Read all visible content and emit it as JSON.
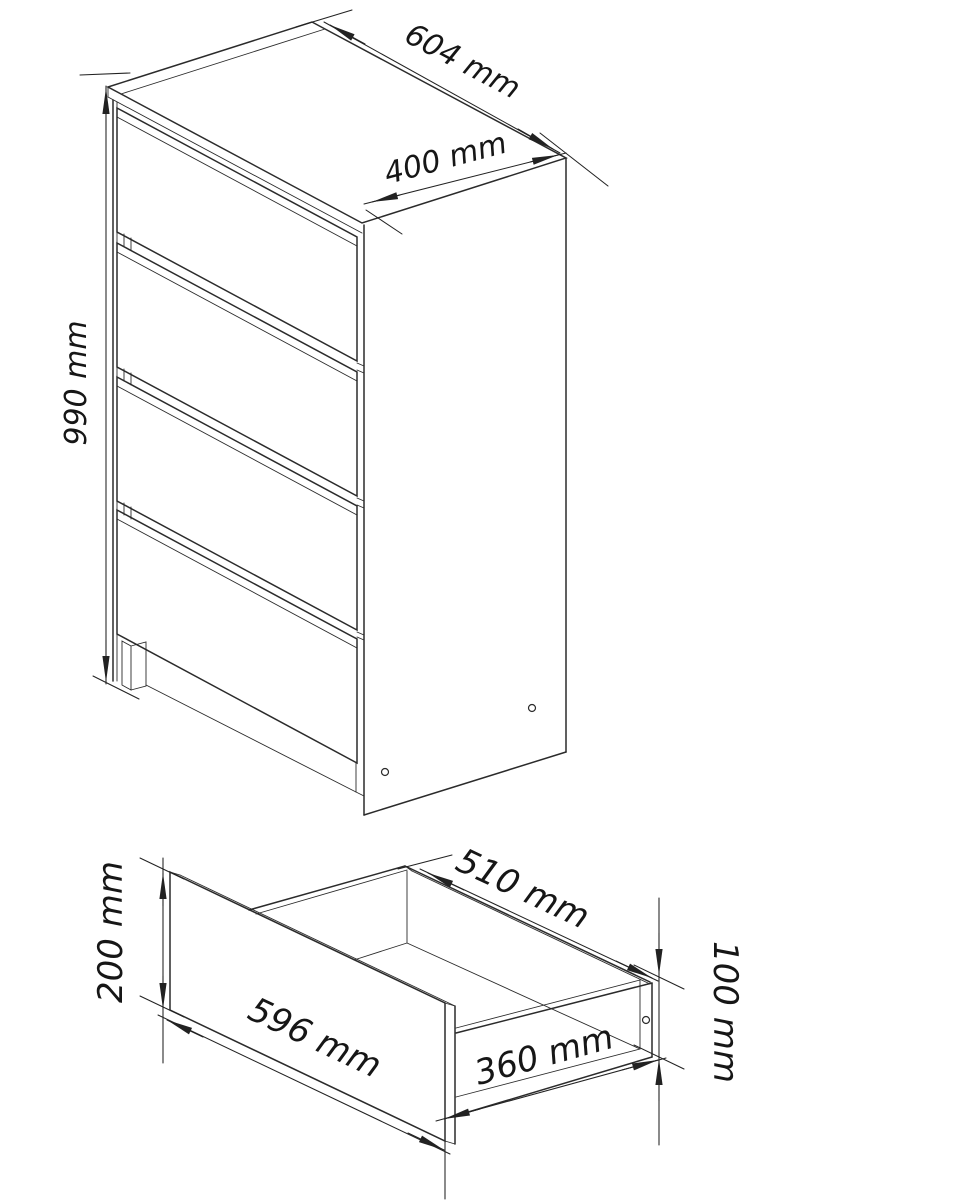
{
  "page": {
    "background": "#ffffff",
    "line_color": "#2b2b2b",
    "text_color": "#161616",
    "unit": "mm"
  },
  "figures": {
    "cabinet": {
      "name": "chest of drawers - isometric view",
      "drawer_count": 4,
      "dimensions": {
        "width": {
          "value": 604,
          "unit": "mm",
          "label": "604 mm"
        },
        "depth": {
          "value": 400,
          "unit": "mm",
          "label": "400 mm"
        },
        "height": {
          "value": 990,
          "unit": "mm",
          "label": "990 mm"
        }
      }
    },
    "drawer": {
      "name": "single drawer box - isometric view",
      "dimensions": {
        "front_height": {
          "value": 200,
          "unit": "mm",
          "label": "200 mm"
        },
        "front_width": {
          "value": 596,
          "unit": "mm",
          "label": "596 mm"
        },
        "inner_width": {
          "value": 510,
          "unit": "mm",
          "label": "510 mm"
        },
        "side_depth": {
          "value": 360,
          "unit": "mm",
          "label": "360 mm"
        },
        "side_height": {
          "value": 100,
          "unit": "mm",
          "label": "100 mm"
        }
      }
    }
  }
}
